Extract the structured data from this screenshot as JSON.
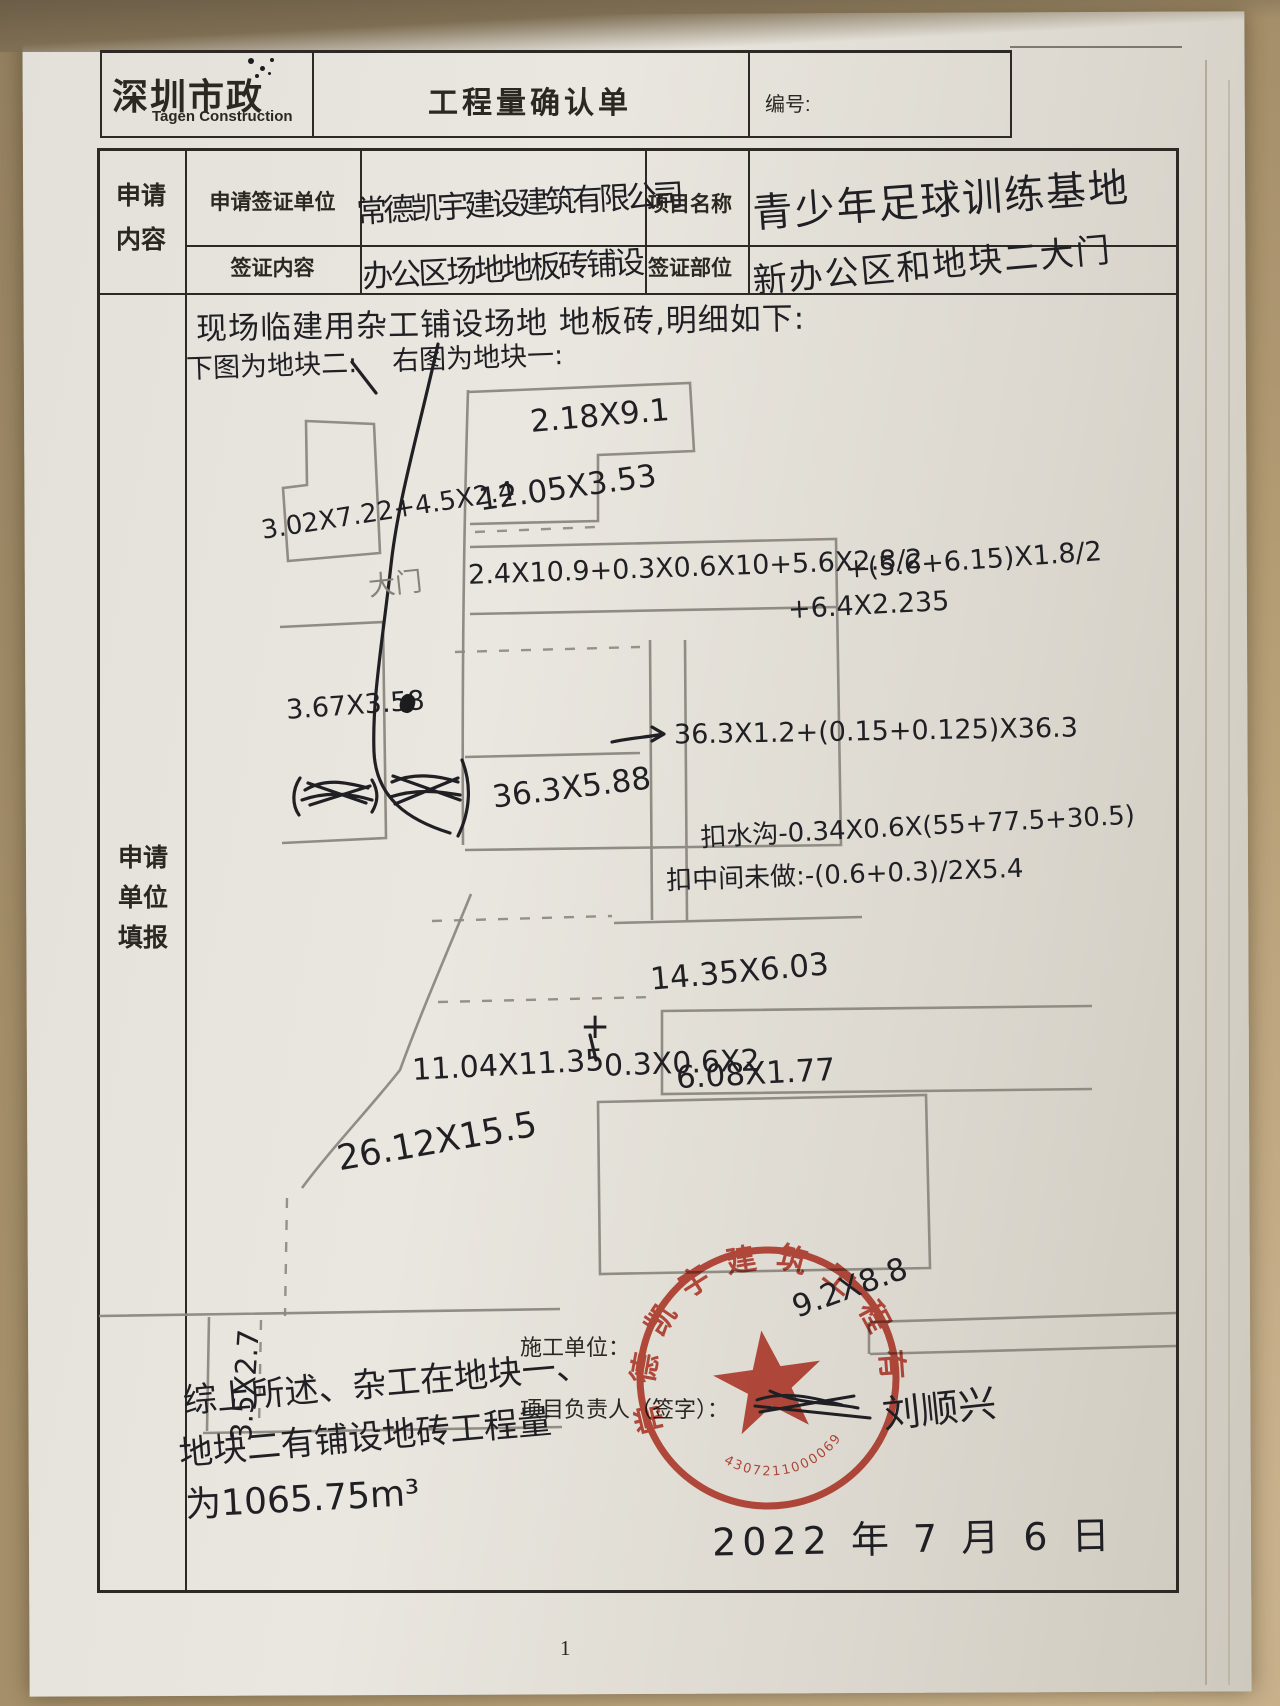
{
  "header": {
    "logo_title": "深圳市政",
    "logo_subtitle": "Tagen Construction",
    "form_title": "工程量确认单",
    "number_label": "编号:"
  },
  "form": {
    "left_label_top_1": "申请",
    "left_label_top_2": "内容",
    "left_label_main_1": "申请",
    "left_label_main_2": "单位",
    "left_label_main_3": "填报",
    "row1_label": "申请签证单位",
    "row1_value": "常德凯宇建设建筑有限公司",
    "row1_label2": "项目名称",
    "row1_value2": "青少年足球训练基地",
    "row2_label": "签证内容",
    "row2_value": "办公区场地地板砖铺设",
    "row2_label2": "签证部位",
    "row2_value2": "新办公区和地块二大门"
  },
  "sketch": {
    "intro": "现场临建用杂工铺设场地 地板砖,明细如下:",
    "left_caption": "下图为地块二:",
    "right_caption": "右图为地块一:",
    "gate_label": "大门",
    "annotations": [
      {
        "text": "2.18X9.1"
      },
      {
        "text": "12.05X3.53"
      },
      {
        "text": "2.4X10.9+0.3X0.6X10+5.6X2.8/2"
      },
      {
        "text": "+(5.6+6.15)X1.8/2"
      },
      {
        "text": "+6.4X2.235"
      },
      {
        "text": "3.02X7.22+4.5X2.4"
      },
      {
        "text": "3.67X3.58"
      },
      {
        "text": "36.3X5.88"
      },
      {
        "text": "36.3X1.2+(0.15+0.125)X36.3"
      },
      {
        "text": "扣水沟-0.34X0.6X(55+77.5+30.5)"
      },
      {
        "text": "扣中间未做:-(0.6+0.3)/2X5.4"
      },
      {
        "text": "14.35X6.03"
      },
      {
        "text": "11.04X11.35"
      },
      {
        "text": "+"
      },
      {
        "text": "0.3X0.6X2"
      },
      {
        "text": "6.08X1.77"
      },
      {
        "text": "26.12X15.5"
      },
      {
        "text": "3.5X2.7"
      },
      {
        "text": "9.2X8.8"
      }
    ]
  },
  "footer": {
    "summary_line1": "综上所述、杂工在地块一、",
    "summary_line2": "地块二有铺设地砖工程量",
    "summary_line3": "为1065.75m³",
    "contractor_label": "施工单位：",
    "manager_label": "项目负责人（签字）：",
    "signature": "刘顺兴",
    "date": "2022 年 7 月 6 日",
    "page_number": "1"
  },
  "stamp": {
    "company": "常德凯宇建筑工程有限公司",
    "serial": "43072110000690",
    "color": "#bf3a2b"
  }
}
